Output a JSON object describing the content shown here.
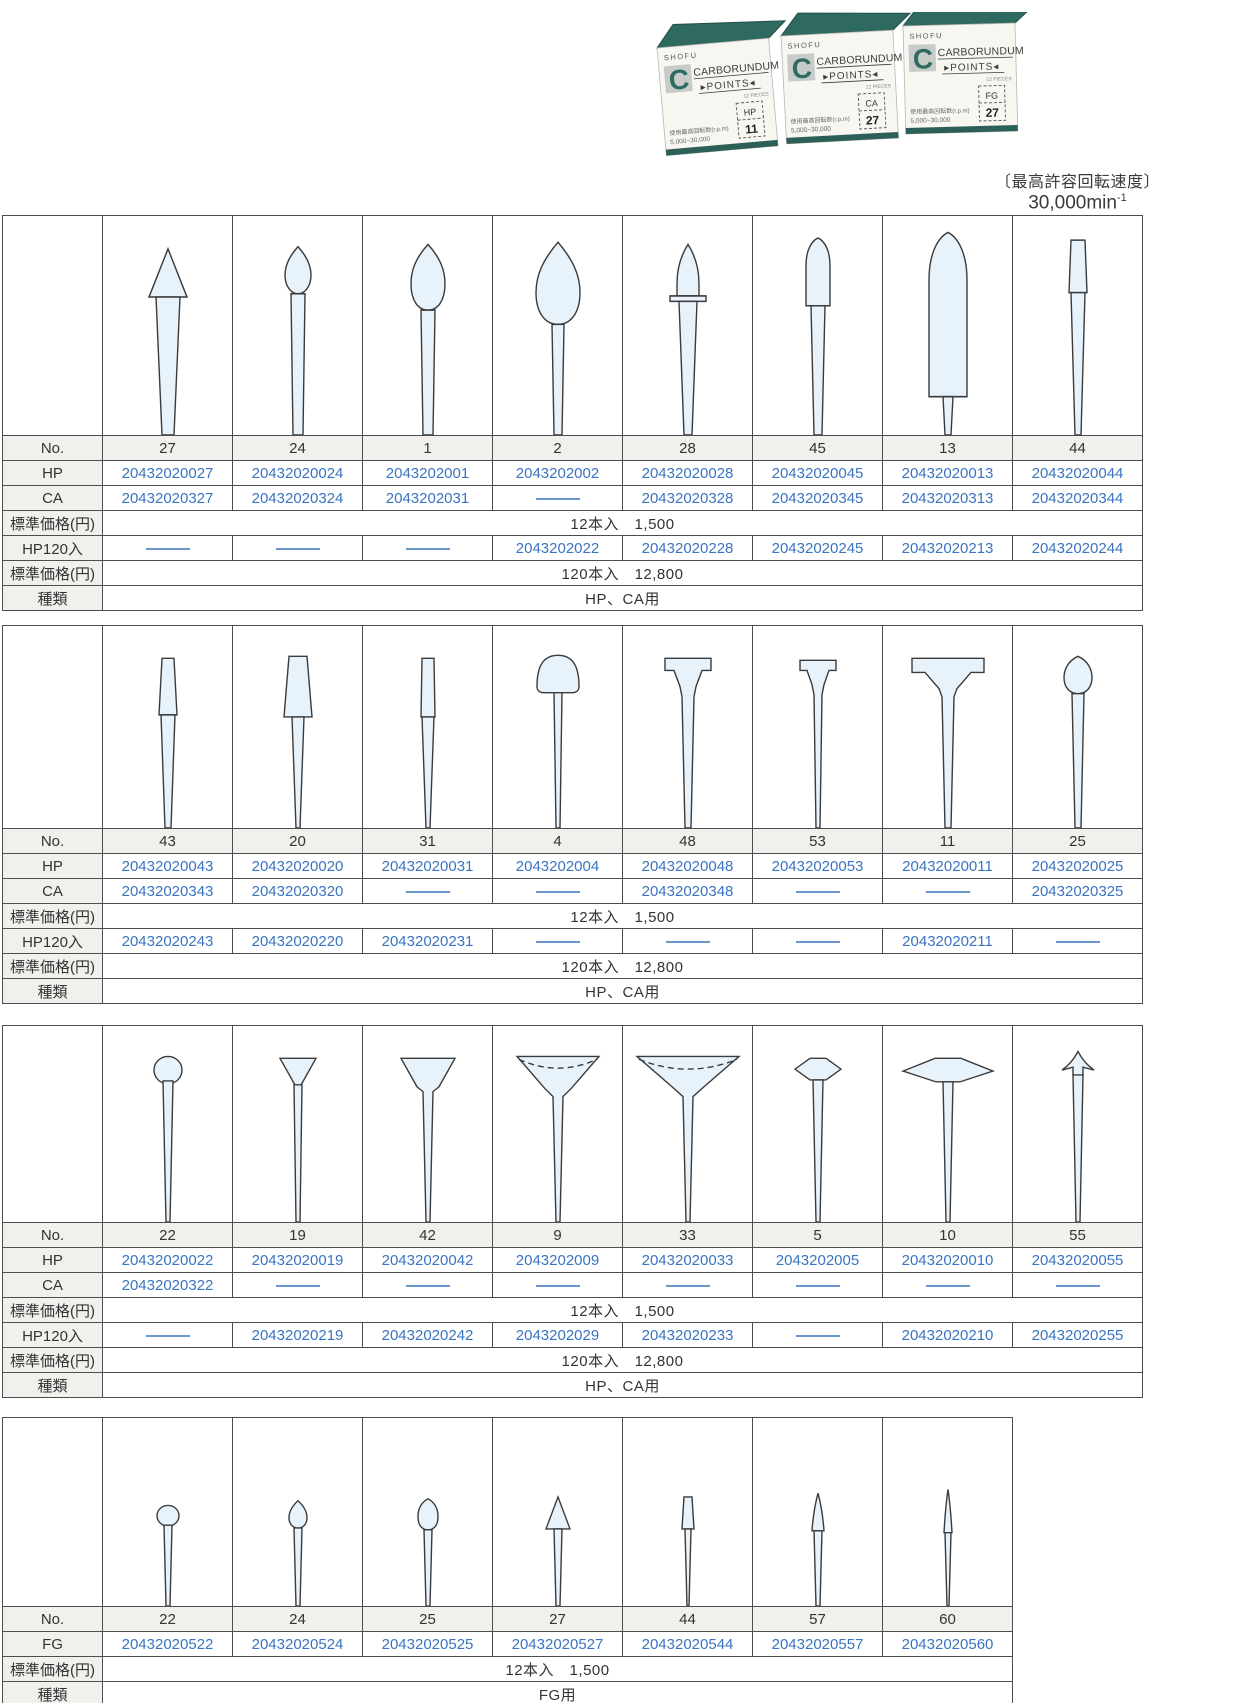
{
  "header": {
    "box_graphic": {
      "brand": "SHOFU",
      "logo_letter": "C",
      "product_line1": "CARBORUNDUM",
      "product_line2": "▸POINTS◂",
      "pieces": "12 PIECES",
      "labels": [
        {
          "type": "HP",
          "no": "11"
        },
        {
          "type": "CA",
          "no": "27"
        },
        {
          "type": "FG",
          "no": "27"
        }
      ],
      "note_line1": "使用最高回転数(r.p.m)",
      "note_line2": "5,000~30,000"
    },
    "max_speed_label": "〔最高許容回転速度〕",
    "max_speed_value": "30,000min",
    "max_speed_sup": "-1"
  },
  "row_labels": {
    "no": "No.",
    "hp": "HP",
    "ca": "CA",
    "fg": "FG",
    "price": "標準価格(円)",
    "hp120": "HP120入",
    "kind": "種類"
  },
  "colors": {
    "code_blue": "#3a74c0",
    "box_teal": "#2f6a61",
    "shape_fill": "#e7f2fb",
    "grid_gray": "#4d4d4d",
    "label_bg": "#f1f0ed"
  },
  "tables": [
    {
      "row_order": [
        "no",
        "hp",
        "ca",
        "price12",
        "hp120",
        "price120",
        "kind"
      ],
      "shape_row_height": 219,
      "price12": "12本入　1,500",
      "price120": "120本入　12,800",
      "kind": "HP、CA用",
      "columns": [
        {
          "no": "27",
          "shape": "cone-small",
          "hp": "20432020027",
          "ca": "20432020327",
          "hp120": null
        },
        {
          "no": "24",
          "shape": "bud-small",
          "hp": "20432020024",
          "ca": "20432020324",
          "hp120": null
        },
        {
          "no": "1",
          "shape": "teardrop-medium",
          "hp": "2043202001",
          "ca": "2043202031",
          "hp120": null
        },
        {
          "no": "2",
          "shape": "teardrop-large",
          "hp": "2043202002",
          "ca": null,
          "hp120": "2043202022"
        },
        {
          "no": "28",
          "shape": "flame-point",
          "hp": "20432020028",
          "ca": "20432020328",
          "hp120": "20432020228"
        },
        {
          "no": "45",
          "shape": "bullet-narrow",
          "hp": "20432020045",
          "ca": "20432020345",
          "hp120": "20432020245"
        },
        {
          "no": "13",
          "shape": "torpedo-large",
          "hp": "20432020013",
          "ca": "20432020313",
          "hp120": "20432020213"
        },
        {
          "no": "44",
          "shape": "taper-cylinder",
          "hp": "20432020044",
          "ca": "20432020344",
          "hp120": "20432020244"
        }
      ]
    },
    {
      "row_order": [
        "no",
        "hp",
        "ca",
        "price12",
        "hp120",
        "price120",
        "kind"
      ],
      "shape_row_height": 202,
      "price12": "12本入　1,500",
      "price120": "120本入　12,800",
      "kind": "HP、CA用",
      "columns": [
        {
          "no": "43",
          "shape": "taper-flat-narrow",
          "hp": "20432020043",
          "ca": "20432020343",
          "hp120": "20432020243"
        },
        {
          "no": "20",
          "shape": "taper-flat-wide",
          "hp": "20432020020",
          "ca": "20432020320",
          "hp120": "20432020220"
        },
        {
          "no": "31",
          "shape": "cylinder-narrow",
          "hp": "20432020031",
          "ca": null,
          "hp120": "20432020231"
        },
        {
          "no": "4",
          "shape": "mushroom-round",
          "hp": "2043202004",
          "ca": null,
          "hp120": null
        },
        {
          "no": "48",
          "shape": "t-flat",
          "hp": "20432020048",
          "ca": "20432020348",
          "hp120": null
        },
        {
          "no": "53",
          "shape": "t-small",
          "hp": "20432020053",
          "ca": null,
          "hp120": null
        },
        {
          "no": "11",
          "shape": "t-wide",
          "hp": "20432020011",
          "ca": null,
          "hp120": "20432020211"
        },
        {
          "no": "25",
          "shape": "bud-round",
          "hp": "20432020025",
          "ca": "20432020325",
          "hp120": null
        }
      ]
    },
    {
      "row_order": [
        "no",
        "hp",
        "ca",
        "price12",
        "hp120",
        "price120",
        "kind"
      ],
      "shape_row_height": 196,
      "price12": "12本入　1,500",
      "price120": "120本入　12,800",
      "kind": "HP、CA用",
      "columns": [
        {
          "no": "22",
          "shape": "ball",
          "hp": "20432020022",
          "ca": "20432020322",
          "hp120": null
        },
        {
          "no": "19",
          "shape": "inverted-cone-small",
          "hp": "20432020019",
          "ca": null,
          "hp120": "20432020219"
        },
        {
          "no": "42",
          "shape": "flare-cup",
          "hp": "20432020042",
          "ca": null,
          "hp120": "20432020242"
        },
        {
          "no": "9",
          "shape": "hollow-cup-wide",
          "hp": "2043202009",
          "ca": null,
          "hp120": "2043202029"
        },
        {
          "no": "33",
          "shape": "hollow-cup-xwide",
          "hp": "20432020033",
          "ca": null,
          "hp120": "20432020233"
        },
        {
          "no": "5",
          "shape": "knife-edge",
          "hp": "2043202005",
          "ca": null,
          "hp120": null
        },
        {
          "no": "10",
          "shape": "wheel-wide",
          "hp": "20432020010",
          "ca": null,
          "hp120": "20432020210"
        },
        {
          "no": "55",
          "shape": "arrow-point",
          "hp": "20432020055",
          "ca": null,
          "hp120": "20432020255"
        }
      ]
    },
    {
      "row_order": [
        "no",
        "fg",
        "price12",
        "kind"
      ],
      "shape_row_height": 188,
      "price12": "12本入　1,500",
      "kind": "FG用",
      "columns": [
        {
          "no": "22",
          "shape": "fg-ball",
          "fg": "20432020522"
        },
        {
          "no": "24",
          "shape": "fg-bud",
          "fg": "20432020524"
        },
        {
          "no": "25",
          "shape": "fg-egg",
          "fg": "20432020525"
        },
        {
          "no": "27",
          "shape": "fg-cone",
          "fg": "20432020527"
        },
        {
          "no": "44",
          "shape": "fg-taper",
          "fg": "20432020544"
        },
        {
          "no": "57",
          "shape": "fg-point",
          "fg": "20432020557"
        },
        {
          "no": "60",
          "shape": "fg-needle",
          "fg": "20432020560"
        }
      ]
    }
  ]
}
